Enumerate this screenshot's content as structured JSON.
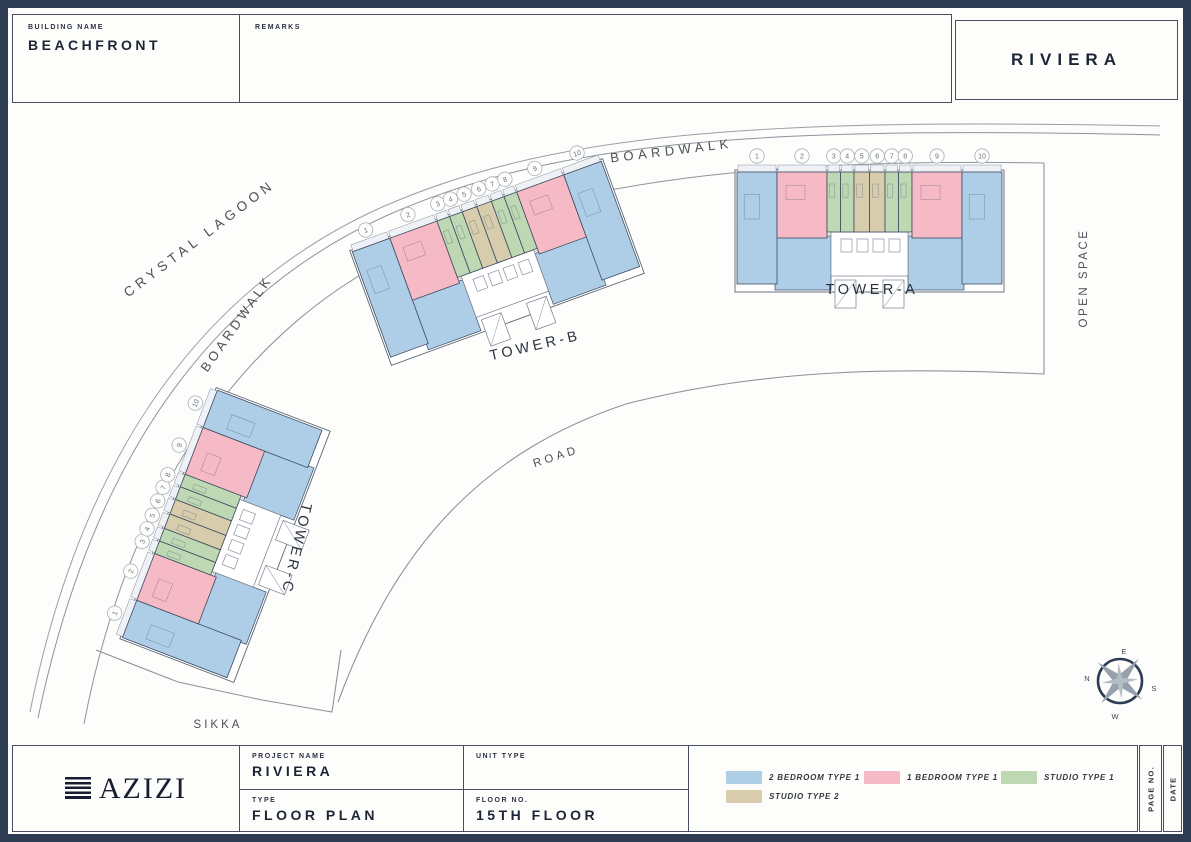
{
  "header": {
    "building_name_label": "BUILDING NAME",
    "building_name": "BEACHFRONT",
    "remarks_label": "REMARKS",
    "sheet_title": "RIVIERA"
  },
  "plan": {
    "labels": {
      "boardwalk_top": "BOARDWALK",
      "boardwalk_left": "BOARDWALK",
      "crystal_lagoon": "CRYSTAL LAGOON",
      "open_space": "OPEN SPACE",
      "road": "ROAD",
      "sikka": "SIKKA"
    },
    "compass": {
      "top": "E",
      "left": "N",
      "right": "S",
      "bottom": "W"
    },
    "towers": [
      {
        "id": "tower-a",
        "label": "TOWER-A",
        "units": [
          {
            "no": "1",
            "type": "2-bedroom-type-1"
          },
          {
            "no": "2",
            "type": "1-bedroom-type-1"
          },
          {
            "no": "3",
            "type": "studio-type-1"
          },
          {
            "no": "4",
            "type": "studio-type-1"
          },
          {
            "no": "5",
            "type": "studio-type-2"
          },
          {
            "no": "6",
            "type": "studio-type-2"
          },
          {
            "no": "7",
            "type": "studio-type-1"
          },
          {
            "no": "8",
            "type": "studio-type-1"
          },
          {
            "no": "9",
            "type": "1-bedroom-type-1"
          },
          {
            "no": "10",
            "type": "2-bedroom-type-1"
          }
        ]
      },
      {
        "id": "tower-b",
        "label": "TOWER-B",
        "units": [
          {
            "no": "1",
            "type": "2-bedroom-type-1"
          },
          {
            "no": "2",
            "type": "1-bedroom-type-1"
          },
          {
            "no": "3",
            "type": "studio-type-1"
          },
          {
            "no": "4",
            "type": "studio-type-1"
          },
          {
            "no": "5",
            "type": "studio-type-2"
          },
          {
            "no": "6",
            "type": "studio-type-2"
          },
          {
            "no": "7",
            "type": "studio-type-1"
          },
          {
            "no": "8",
            "type": "studio-type-1"
          },
          {
            "no": "9",
            "type": "1-bedroom-type-1"
          },
          {
            "no": "10",
            "type": "2-bedroom-type-1"
          }
        ]
      },
      {
        "id": "tower-c",
        "label": "TOWER-C",
        "units": [
          {
            "no": "1",
            "type": "2-bedroom-type-1"
          },
          {
            "no": "2",
            "type": "1-bedroom-type-1"
          },
          {
            "no": "3",
            "type": "studio-type-1"
          },
          {
            "no": "4",
            "type": "studio-type-1"
          },
          {
            "no": "5",
            "type": "studio-type-2"
          },
          {
            "no": "6",
            "type": "studio-type-2"
          },
          {
            "no": "7",
            "type": "studio-type-1"
          },
          {
            "no": "8",
            "type": "studio-type-1"
          },
          {
            "no": "9",
            "type": "1-bedroom-type-1"
          },
          {
            "no": "10",
            "type": "2-bedroom-type-1"
          }
        ]
      }
    ]
  },
  "unit_types": {
    "2-bedroom-type-1": {
      "color": "#aecde6"
    },
    "1-bedroom-type-1": {
      "color": "#f5bac6"
    },
    "studio-type-1": {
      "color": "#bdd8b2"
    },
    "studio-type-2": {
      "color": "#d7cdad"
    }
  },
  "legend": [
    {
      "type": "2-bedroom-type-1",
      "label": "2 BEDROOM TYPE 1"
    },
    {
      "type": "1-bedroom-type-1",
      "label": "1 BEDROOM TYPE 1"
    },
    {
      "type": "studio-type-1",
      "label": "STUDIO TYPE 1"
    },
    {
      "type": "studio-type-2",
      "label": "STUDIO TYPE 2"
    }
  ],
  "footer": {
    "brand": "AZIZI",
    "project_name_label": "PROJECT NAME",
    "project_name": "RIVIERA",
    "type_label": "TYPE",
    "type_value": "FLOOR PLAN",
    "unit_type_label": "UNIT TYPE",
    "floor_no_label": "FLOOR NO.",
    "floor_no": "15TH FLOOR",
    "page_no_label": "PAGE NO.",
    "date_label": "DATE"
  },
  "colors": {
    "frame": "#2d3c53",
    "line": "#8d939c",
    "dark_line": "#474f60"
  }
}
